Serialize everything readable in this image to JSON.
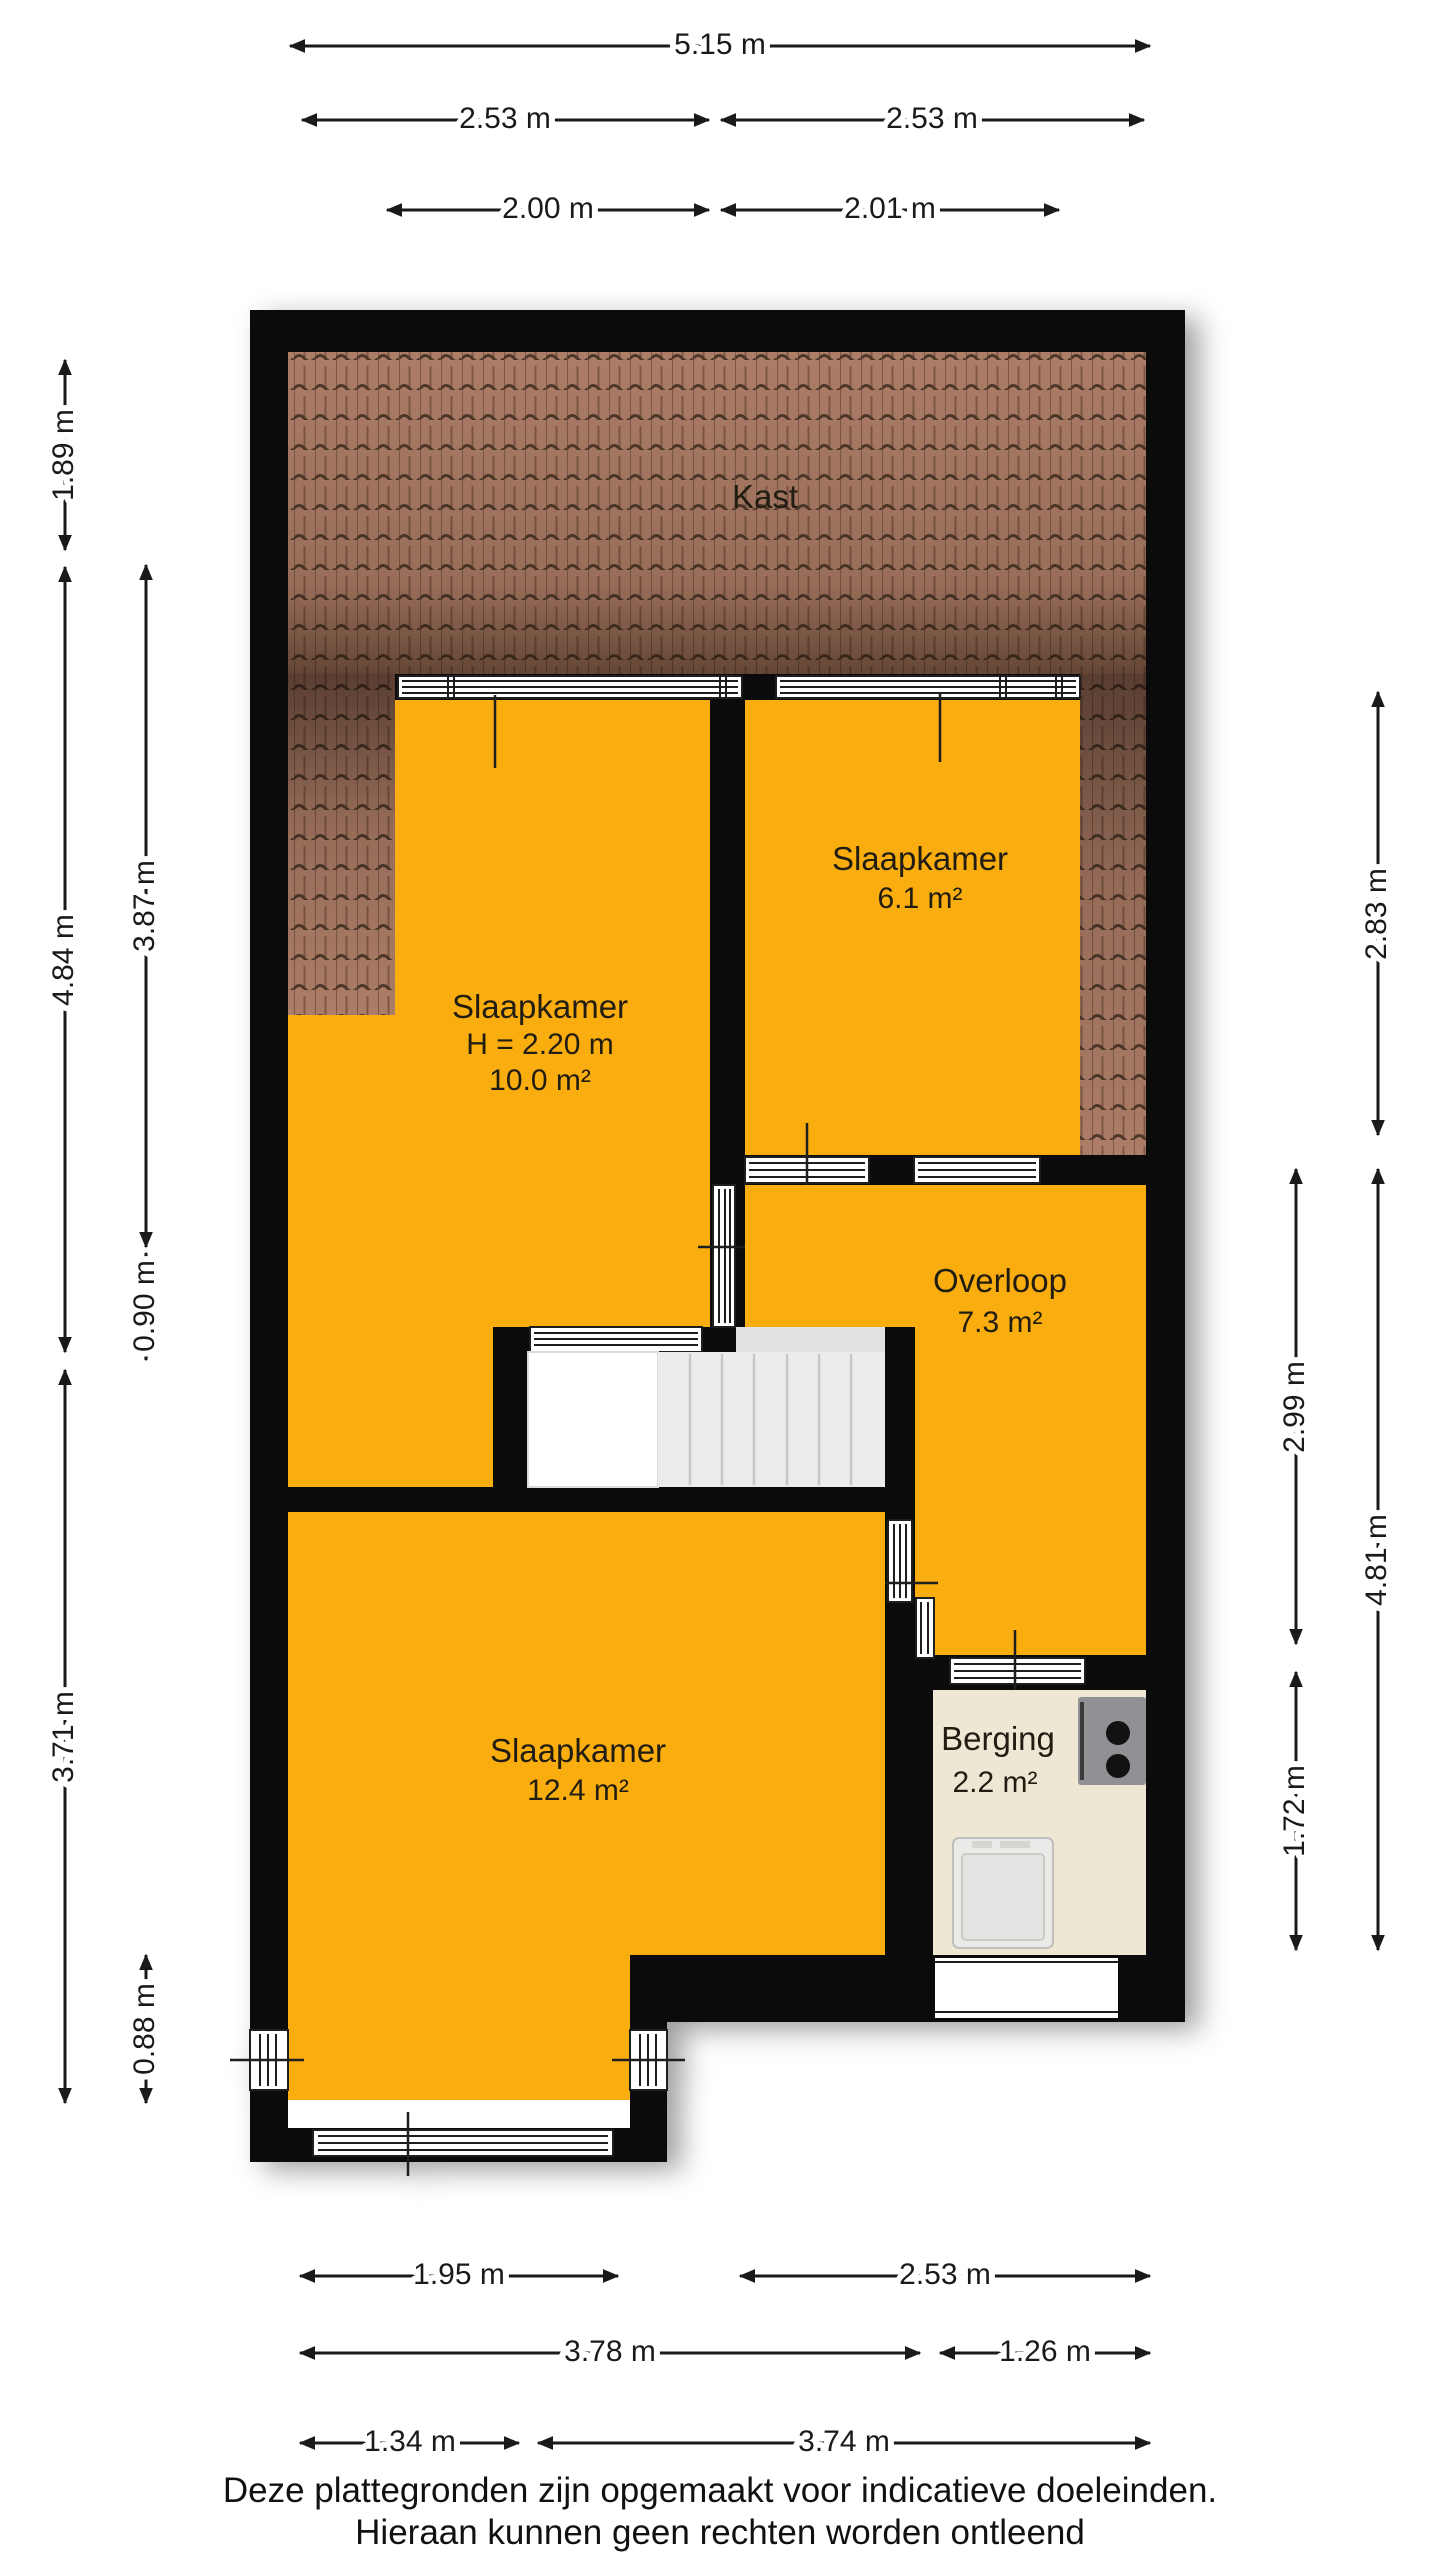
{
  "plan": {
    "rooms": {
      "kast": {
        "label": "Kast"
      },
      "slaapkamer_links": {
        "label": "Slaapkamer",
        "ceiling_height": "H = 2.20 m",
        "area": "10.0 m²"
      },
      "slaapkamer_rechts": {
        "label": "Slaapkamer",
        "area": "6.1 m²"
      },
      "overloop": {
        "label": "Overloop",
        "area": "7.3 m²"
      },
      "slaapkamer_groot": {
        "label": "Slaapkamer",
        "area": "12.4 m²"
      },
      "berging": {
        "label": "Berging",
        "area": "2.2 m²"
      }
    },
    "fixtures": [
      "staircase",
      "boiler",
      "washing-machine"
    ]
  },
  "dimensions": {
    "top": [
      "5.15 m",
      "2.53 m",
      "2.53 m",
      "2.00 m",
      "2.01 m"
    ],
    "left": [
      "1.89 m",
      "4.84 m",
      "3.71 m",
      "3.87 m",
      "0.90 m",
      "0.88 m"
    ],
    "right": [
      "2.83 m",
      "4.81 m",
      "2.99 m",
      "1.72 m"
    ],
    "bottom": [
      "1.95 m",
      "2.53 m",
      "3.78 m",
      "1.26 m",
      "1.34 m",
      "3.74 m"
    ]
  },
  "footer": {
    "line1": "Deze plattegronden zijn opgemaakt voor indicatieve doeleinden.",
    "line2": "Hieraan kunnen geen rechten worden ontleend"
  },
  "colors": {
    "wall": "#0b0b0b",
    "room": "#FAAD0F",
    "berging": "#EDE7D3",
    "roof-base": "#AC7D67",
    "roof-line": "#4E382A",
    "stairs": "#ECECEC",
    "ink": "#1a1a1a"
  }
}
